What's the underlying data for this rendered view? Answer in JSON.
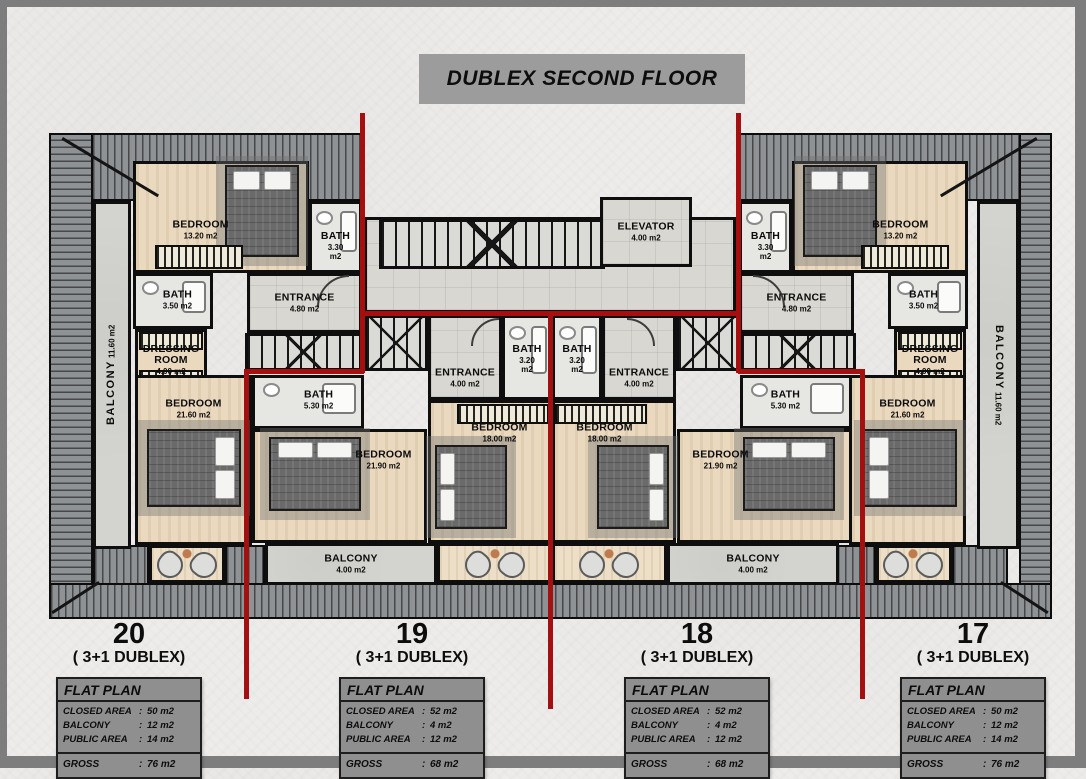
{
  "title": {
    "text": "DUBLEX SECOND FLOOR"
  },
  "colors": {
    "red_divider": "#a50f0f",
    "banner_gray": "#9c9c9c",
    "table_gray": "#8f8f8f"
  },
  "plan": {
    "position": {
      "left": 40,
      "top": 118,
      "width": 1006,
      "height": 500
    },
    "roofs": [
      {
        "x": 2,
        "y": 8,
        "w": 313,
        "h": 68,
        "dir": "v"
      },
      {
        "x": 689,
        "y": 8,
        "w": 316,
        "h": 68,
        "dir": "v"
      },
      {
        "x": 2,
        "y": 8,
        "w": 44,
        "h": 486,
        "dir": "h"
      },
      {
        "x": 972,
        "y": 8,
        "w": 33,
        "h": 486,
        "dir": "h"
      },
      {
        "x": 2,
        "y": 458,
        "w": 1003,
        "h": 36,
        "dir": "v"
      },
      {
        "x": 46,
        "y": 420,
        "w": 56,
        "h": 40,
        "dir": "v"
      },
      {
        "x": 178,
        "y": 420,
        "w": 40,
        "h": 40,
        "dir": "v"
      },
      {
        "x": 789,
        "y": 420,
        "w": 40,
        "h": 40,
        "dir": "v"
      },
      {
        "x": 905,
        "y": 420,
        "w": 56,
        "h": 40,
        "dir": "v"
      }
    ],
    "balconies": [
      {
        "id": "balcony-left",
        "label": "BALCONY",
        "area": "11.60 m2",
        "x": 46,
        "y": 76,
        "w": 38,
        "h": 348,
        "read": "up"
      },
      {
        "id": "balcony-right",
        "label": "BALCONY",
        "area": "11.60 m2",
        "x": 930,
        "y": 76,
        "w": 42,
        "h": 348,
        "read": "down"
      }
    ],
    "rooms": [
      {
        "id": "corridor",
        "type": "tile",
        "x": 317,
        "y": 92,
        "w": 372,
        "h": 96
      },
      {
        "id": "stairs-main",
        "type": "stairs",
        "x": 332,
        "y": 94,
        "w": 226,
        "h": 50
      },
      {
        "id": "elevator",
        "label": "ELEVATOR",
        "area": "4.00 m2",
        "type": "tile",
        "x": 553,
        "y": 72,
        "w": 92,
        "h": 70
      },
      {
        "id": "bedroom-13-left",
        "label": "BEDROOM",
        "area": "13.20 m2",
        "type": "wood",
        "x": 86,
        "y": 36,
        "w": 176,
        "h": 112,
        "lpos": [
          38,
          62
        ]
      },
      {
        "id": "bath-330-left",
        "label": "BATH",
        "area": "3.30 m2",
        "type": "bathroom",
        "x": 262,
        "y": 76,
        "w": 53,
        "h": 72,
        "lpos": [
          50,
          64
        ]
      },
      {
        "id": "entrance-480-left",
        "label": "ENTRANCE",
        "area": "4.80 m2",
        "type": "tile",
        "x": 200,
        "y": 148,
        "w": 115,
        "h": 60
      },
      {
        "id": "stairs-unit20",
        "type": "stairs",
        "x": 198,
        "y": 208,
        "w": 117,
        "h": 38
      },
      {
        "id": "bath-350-left",
        "label": "BATH",
        "area": "3.50 m2",
        "type": "bathroom",
        "x": 86,
        "y": 148,
        "w": 80,
        "h": 56,
        "lpos": [
          56,
          48
        ]
      },
      {
        "id": "dressing-room-left",
        "label": "DRESSING ROOM",
        "area": "4.00 m2",
        "type": "dressing",
        "x": 88,
        "y": 204,
        "w": 72,
        "h": 62
      },
      {
        "id": "bedroom-2160-left",
        "label": "BEDROOM",
        "area": "21.60 m2",
        "type": "wood",
        "x": 88,
        "y": 250,
        "w": 117,
        "h": 170,
        "lpos": [
          50,
          19
        ]
      },
      {
        "id": "terrace-unit20",
        "type": "terrace",
        "x": 102,
        "y": 420,
        "w": 76,
        "h": 38
      },
      {
        "id": "bath-530-left",
        "label": "BATH",
        "area": "5.30 m2",
        "type": "bathroom",
        "x": 205,
        "y": 250,
        "w": 112,
        "h": 54,
        "lpos": [
          60,
          46
        ]
      },
      {
        "id": "bedroom-2190-left",
        "label": "BEDROOM",
        "area": "21.90 m2",
        "type": "wood",
        "x": 205,
        "y": 304,
        "w": 175,
        "h": 114,
        "lpos": [
          76,
          26
        ]
      },
      {
        "id": "stairs-unit19",
        "type": "stairs",
        "x": 317,
        "y": 190,
        "w": 64,
        "h": 56
      },
      {
        "id": "entrance-400-left",
        "label": "ENTRANCE",
        "area": "4.00 m2",
        "type": "tile",
        "x": 381,
        "y": 190,
        "w": 74,
        "h": 85,
        "lpos": [
          50,
          76
        ]
      },
      {
        "id": "bath-320-left",
        "label": "BATH",
        "area": "3.20 m2",
        "type": "bathroom",
        "x": 455,
        "y": 190,
        "w": 50,
        "h": 85,
        "lpos": [
          50,
          52
        ]
      },
      {
        "id": "bedroom-18-left",
        "label": "BEDROOM",
        "area": "18.00 m2",
        "type": "wood",
        "x": 381,
        "y": 275,
        "w": 124,
        "h": 143,
        "lpos": [
          58,
          22
        ]
      },
      {
        "id": "balcony-400-left",
        "label": "BALCONY",
        "area": "4.00 m2",
        "type": "concrete",
        "x": 218,
        "y": 418,
        "w": 172,
        "h": 42
      },
      {
        "id": "terrace-unit19",
        "type": "terrace",
        "x": 390,
        "y": 418,
        "w": 115,
        "h": 40
      },
      {
        "id": "bath-320-right",
        "label": "BATH",
        "area": "3.20 m2",
        "type": "bathroom",
        "x": 505,
        "y": 190,
        "w": 50,
        "h": 85,
        "lpos": [
          50,
          52
        ]
      },
      {
        "id": "entrance-400-right",
        "label": "ENTRANCE",
        "area": "4.00 m2",
        "type": "tile",
        "x": 555,
        "y": 190,
        "w": 74,
        "h": 85,
        "lpos": [
          50,
          76
        ]
      },
      {
        "id": "stairs-unit18",
        "type": "stairs",
        "x": 629,
        "y": 190,
        "w": 64,
        "h": 56
      },
      {
        "id": "bedroom-18-right",
        "label": "BEDROOM",
        "area": "18.00 m2",
        "type": "wood",
        "x": 505,
        "y": 275,
        "w": 124,
        "h": 143,
        "lpos": [
          42,
          22
        ]
      },
      {
        "id": "bedroom-2190-right",
        "label": "BEDROOM",
        "area": "21.90 m2",
        "type": "wood",
        "x": 630,
        "y": 304,
        "w": 175,
        "h": 114,
        "lpos": [
          24,
          26
        ]
      },
      {
        "id": "bath-530-right",
        "label": "BATH",
        "area": "5.30 m2",
        "type": "bathroom",
        "x": 693,
        "y": 250,
        "w": 112,
        "h": 54,
        "lpos": [
          40,
          46
        ]
      },
      {
        "id": "terrace-unit18",
        "type": "terrace",
        "x": 505,
        "y": 418,
        "w": 115,
        "h": 40
      },
      {
        "id": "balcony-400-right",
        "label": "BALCONY",
        "area": "4.00 m2",
        "type": "concrete",
        "x": 620,
        "y": 418,
        "w": 172,
        "h": 42
      },
      {
        "id": "bedroom-13-right",
        "label": "BEDROOM",
        "area": "13.20 m2",
        "type": "wood",
        "x": 745,
        "y": 36,
        "w": 176,
        "h": 112,
        "lpos": [
          62,
          62
        ]
      },
      {
        "id": "bath-330-right",
        "label": "BATH",
        "area": "3.30 m2",
        "type": "bathroom",
        "x": 692,
        "y": 76,
        "w": 53,
        "h": 72,
        "lpos": [
          50,
          64
        ]
      },
      {
        "id": "entrance-480-right",
        "label": "ENTRANCE",
        "area": "4.80 m2",
        "type": "tile",
        "x": 692,
        "y": 148,
        "w": 115,
        "h": 60
      },
      {
        "id": "stairs-unit17",
        "type": "stairs",
        "x": 692,
        "y": 208,
        "w": 117,
        "h": 38
      },
      {
        "id": "bath-350-right",
        "label": "BATH",
        "area": "3.50 m2",
        "type": "bathroom",
        "x": 841,
        "y": 148,
        "w": 80,
        "h": 56,
        "lpos": [
          44,
          48
        ]
      },
      {
        "id": "dressing-room-right",
        "label": "DRESSING ROOM",
        "area": "4.00 m2",
        "type": "dressing",
        "x": 847,
        "y": 204,
        "w": 72,
        "h": 62
      },
      {
        "id": "bedroom-2160-right",
        "label": "BEDROOM",
        "area": "21.60 m2",
        "type": "wood",
        "x": 802,
        "y": 250,
        "w": 117,
        "h": 170,
        "lpos": [
          50,
          19
        ]
      },
      {
        "id": "terrace-unit17",
        "type": "terrace",
        "x": 829,
        "y": 420,
        "w": 76,
        "h": 38
      }
    ],
    "furniture": [
      {
        "type": "bed",
        "p": "top",
        "x": 178,
        "y": 40,
        "w": 74,
        "h": 92
      },
      {
        "type": "bed",
        "p": "top",
        "x": 756,
        "y": 40,
        "w": 74,
        "h": 92
      },
      {
        "type": "bed",
        "p": "right",
        "x": 100,
        "y": 304,
        "w": 94,
        "h": 78
      },
      {
        "type": "bed",
        "p": "top",
        "x": 222,
        "y": 312,
        "w": 92,
        "h": 74
      },
      {
        "type": "bed",
        "p": "left",
        "x": 388,
        "y": 320,
        "w": 72,
        "h": 84
      },
      {
        "type": "bed",
        "p": "right",
        "x": 550,
        "y": 320,
        "w": 72,
        "h": 84
      },
      {
        "type": "bed",
        "p": "top",
        "x": 696,
        "y": 312,
        "w": 92,
        "h": 74
      },
      {
        "type": "bed",
        "p": "left",
        "x": 816,
        "y": 304,
        "w": 94,
        "h": 78
      },
      {
        "type": "wardrobe",
        "x": 108,
        "y": 120,
        "w": 88,
        "h": 24
      },
      {
        "type": "wardrobe",
        "x": 814,
        "y": 120,
        "w": 88,
        "h": 24
      },
      {
        "type": "wardrobe",
        "x": 410,
        "y": 279,
        "w": 92,
        "h": 20
      },
      {
        "type": "wardrobe",
        "x": 508,
        "y": 279,
        "w": 92,
        "h": 20
      },
      {
        "type": "chairs",
        "x": 110,
        "y": 423,
        "w": 60,
        "h": 32
      },
      {
        "type": "chairs",
        "x": 418,
        "y": 423,
        "w": 60,
        "h": 32
      },
      {
        "type": "chairs",
        "x": 532,
        "y": 423,
        "w": 60,
        "h": 32
      },
      {
        "type": "chairs",
        "x": 836,
        "y": 423,
        "w": 60,
        "h": 32
      },
      {
        "type": "arc",
        "x": 270,
        "y": 150,
        "w": 32,
        "h": 32,
        "rot": 0
      },
      {
        "type": "arc",
        "x": 706,
        "y": 150,
        "w": 32,
        "h": 32,
        "rot": 90
      },
      {
        "type": "arc",
        "x": 424,
        "y": 193,
        "w": 28,
        "h": 28,
        "rot": 0
      },
      {
        "type": "arc",
        "x": 580,
        "y": 193,
        "w": 28,
        "h": 28,
        "rot": 90
      },
      {
        "type": "hip",
        "x": 16,
        "y": 12,
        "w": 112,
        "rot": 31,
        "origin": "0 0"
      },
      {
        "type": "hip",
        "x": 877,
        "y": 12,
        "w": 112,
        "rot": -31,
        "origin": "100% 0"
      },
      {
        "type": "hip",
        "x": 6,
        "y": 486,
        "w": 56,
        "rot": -33,
        "origin": "0 100%"
      },
      {
        "type": "hip",
        "x": 944,
        "y": 486,
        "w": 56,
        "rot": 33,
        "origin": "100% 100%"
      }
    ],
    "red_lines": [
      {
        "x": 313,
        "y": -12,
        "w": 5,
        "h": 260
      },
      {
        "x": 689,
        "y": -12,
        "w": 5,
        "h": 260
      },
      {
        "x": 313,
        "y": 186,
        "w": 381,
        "h": 5
      },
      {
        "x": 197,
        "y": 244,
        "w": 120,
        "h": 5
      },
      {
        "x": 691,
        "y": 244,
        "w": 124,
        "h": 5
      },
      {
        "x": 197,
        "y": 244,
        "w": 5,
        "h": 330
      },
      {
        "x": 813,
        "y": 244,
        "w": 5,
        "h": 330
      },
      {
        "x": 501,
        "y": 186,
        "w": 5,
        "h": 398
      }
    ]
  },
  "banner_box": {
    "left": 412,
    "top": 47,
    "width": 326,
    "height": 50
  },
  "units_top": 612,
  "units": [
    {
      "id": "unit-20",
      "number": "20",
      "type_label": "( 3+1 DUBLEX)",
      "card": {
        "left": 28,
        "width": 188
      },
      "flat_plan": {
        "header": "FLAT PLAN",
        "rows": [
          {
            "label": "CLOSED AREA",
            "value": "50 m2"
          },
          {
            "label": "BALCONY",
            "value": "12 m2"
          },
          {
            "label": "PUBLIC AREA",
            "value": "14 m2"
          }
        ],
        "gross": {
          "label": "GROSS",
          "value": "76 m2"
        }
      }
    },
    {
      "id": "unit-19",
      "number": "19",
      "type_label": "( 3+1 DUBLEX)",
      "card": {
        "left": 311,
        "width": 188
      },
      "flat_plan": {
        "header": "FLAT PLAN",
        "rows": [
          {
            "label": "CLOSED AREA",
            "value": "52 m2"
          },
          {
            "label": "BALCONY",
            "value": "4 m2"
          },
          {
            "label": "PUBLIC AREA",
            "value": "12 m2"
          }
        ],
        "gross": {
          "label": "GROSS",
          "value": "68 m2"
        }
      }
    },
    {
      "id": "unit-18",
      "number": "18",
      "type_label": "( 3+1 DUBLEX)",
      "card": {
        "left": 596,
        "width": 188
      },
      "flat_plan": {
        "header": "FLAT PLAN",
        "rows": [
          {
            "label": "CLOSED AREA",
            "value": "52 m2"
          },
          {
            "label": "BALCONY",
            "value": "4 m2"
          },
          {
            "label": "PUBLIC AREA",
            "value": "12 m2"
          }
        ],
        "gross": {
          "label": "GROSS",
          "value": "68 m2"
        }
      }
    },
    {
      "id": "unit-17",
      "number": "17",
      "type_label": "( 3+1 DUBLEX)",
      "card": {
        "left": 872,
        "width": 188
      },
      "flat_plan": {
        "header": "FLAT PLAN",
        "rows": [
          {
            "label": "CLOSED AREA",
            "value": "50 m2"
          },
          {
            "label": "BALCONY",
            "value": "12 m2"
          },
          {
            "label": "PUBLIC AREA",
            "value": "14 m2"
          }
        ],
        "gross": {
          "label": "GROSS",
          "value": "76 m2"
        }
      }
    }
  ]
}
